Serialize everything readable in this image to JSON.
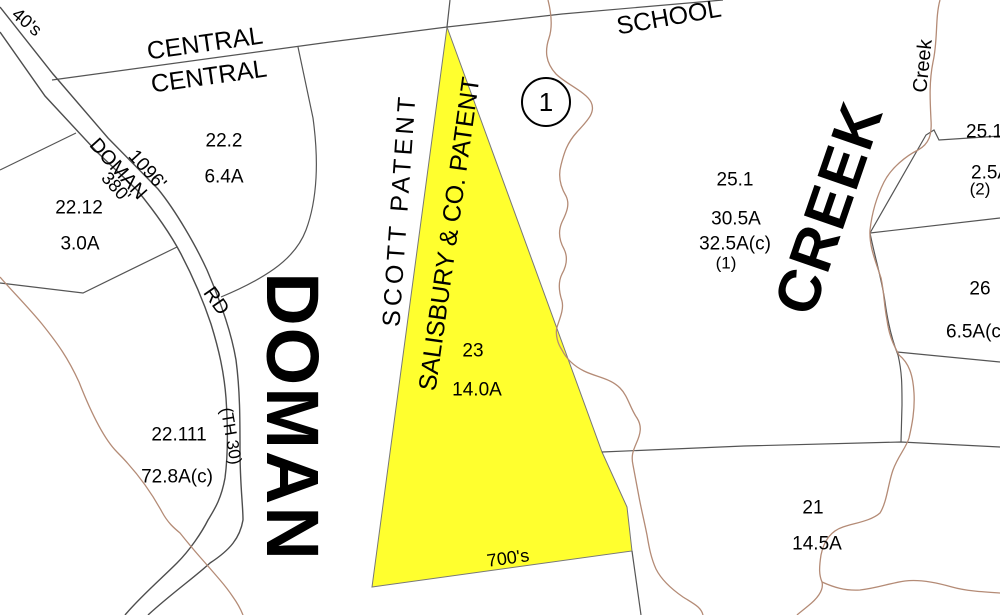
{
  "district_marker": "1",
  "area_names": {
    "doman_large": "DOMAN",
    "creek_large": "CREEK",
    "creek_small": "Creek",
    "scott_patent": "SCOTT PATENT",
    "salisbury_patent": "SALISBURY & CO. PATENT"
  },
  "roads": {
    "central_upper": "CENTRAL",
    "central_lower": "CENTRAL",
    "school": "SCHOOL",
    "doman_rd_name": "DOMAN",
    "doman_rd_suffix": "RD",
    "doman_rd_designation": "(TH 30)"
  },
  "dimensions": {
    "frontage_1096": "1096'",
    "frontage_380": "380'",
    "range_top_left": "40's",
    "range_bottom": "700's"
  },
  "parcels": {
    "p22_2": {
      "id": "22.2",
      "area": "6.4A"
    },
    "p22_12": {
      "id": "22.12",
      "area": "3.0A"
    },
    "p22_111": {
      "id": "22.111",
      "area": "72.8A(c)"
    },
    "p23": {
      "id": "23",
      "area": "14.0A",
      "highlighted": true
    },
    "p25_1": {
      "id": "25.1",
      "area": "30.5A",
      "area_calc": "32.5A(c)",
      "note": "(1)"
    },
    "p25_edge": {
      "id": "25.1",
      "area": "2.5A",
      "note": "(2)"
    },
    "p26": {
      "id": "26",
      "area": "6.5A(c)"
    },
    "p21": {
      "id": "21",
      "area": "14.5A"
    }
  },
  "colors": {
    "highlight_fill": "#ffff2e",
    "boundary_line": "#555555",
    "road_line": "#4d4d4d",
    "creek_line": "#b48b76",
    "background": "#ffffff"
  }
}
